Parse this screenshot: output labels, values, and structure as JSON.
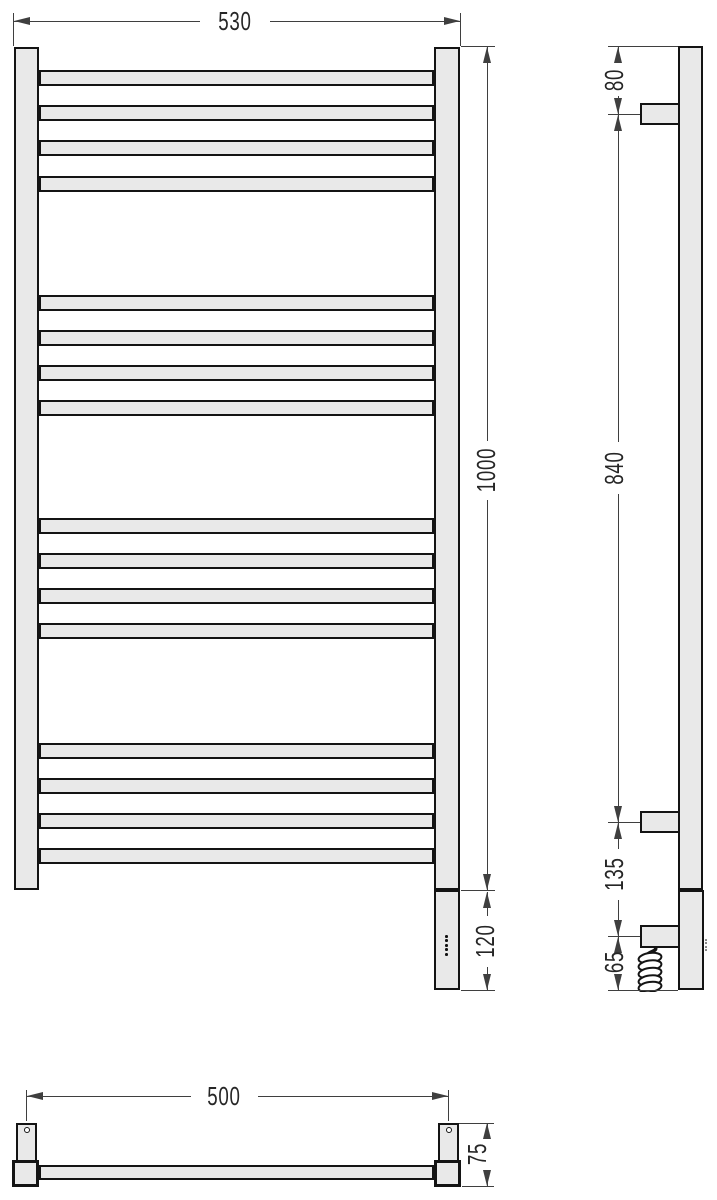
{
  "dimensions": {
    "front_width": "530",
    "front_height": "1000",
    "front_heater_height": "120",
    "side_top_offset": "80",
    "side_bracket_span": "840",
    "side_bracket_to_box": "135",
    "side_box_to_bottom": "65",
    "plan_mount_span": "500",
    "plan_depth": "75"
  },
  "structure": {
    "views": [
      "front",
      "side",
      "plan"
    ],
    "rung_count": 16,
    "rung_groups": 4,
    "rungs_per_group": 4,
    "indicator_dot_count": 5
  },
  "colors": {
    "fill": "#e9e9e9",
    "line": "#141414",
    "dim": "#3f3f3f",
    "text": "#262626",
    "background": "#ffffff"
  }
}
